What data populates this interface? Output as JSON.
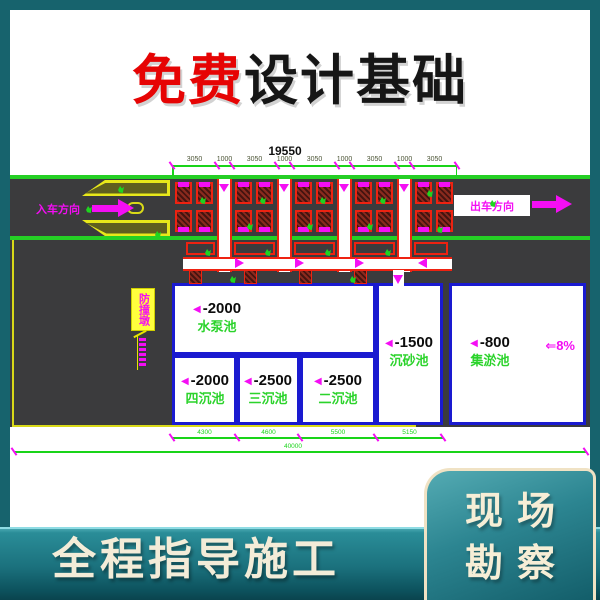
{
  "banner": {
    "free": "免费",
    "rest": "设计基础"
  },
  "drawing": {
    "dim_top_total": "19550",
    "dim_top_segments": [
      "3050",
      "1000",
      "3050",
      "1000",
      "3050",
      "1000",
      "3050",
      "1000",
      "3050"
    ],
    "entry_label": "入车方向",
    "exit_label": "出车方向",
    "side_tag": "防撞墩",
    "slope_label": "⇐8%",
    "pools": [
      {
        "depth": "-2000",
        "name": "水泵池"
      },
      {
        "depth": "-2000",
        "name": "四沉池"
      },
      {
        "depth": "-2500",
        "name": "三沉池"
      },
      {
        "depth": "-2500",
        "name": "二沉池"
      },
      {
        "depth": "-1500",
        "name": "沉砂池"
      },
      {
        "depth": "-800",
        "name": "集淤池"
      }
    ],
    "dim_bottom_segments": [
      "4300",
      "4600",
      "5500",
      "5150"
    ],
    "dim_bottom_total": "40000"
  },
  "footer": {
    "strip_text": "全程指导施工",
    "card_line1": "现场",
    "card_line2": "勘察"
  },
  "colors": {
    "teal_bg": "#17636d",
    "title_red": "#e60404",
    "cad_green": "#25cf25",
    "cad_magenta": "#f40ef4",
    "cad_blue": "#1a1ad0",
    "cad_red": "#ee2211",
    "cream": "#f3ecd8"
  }
}
